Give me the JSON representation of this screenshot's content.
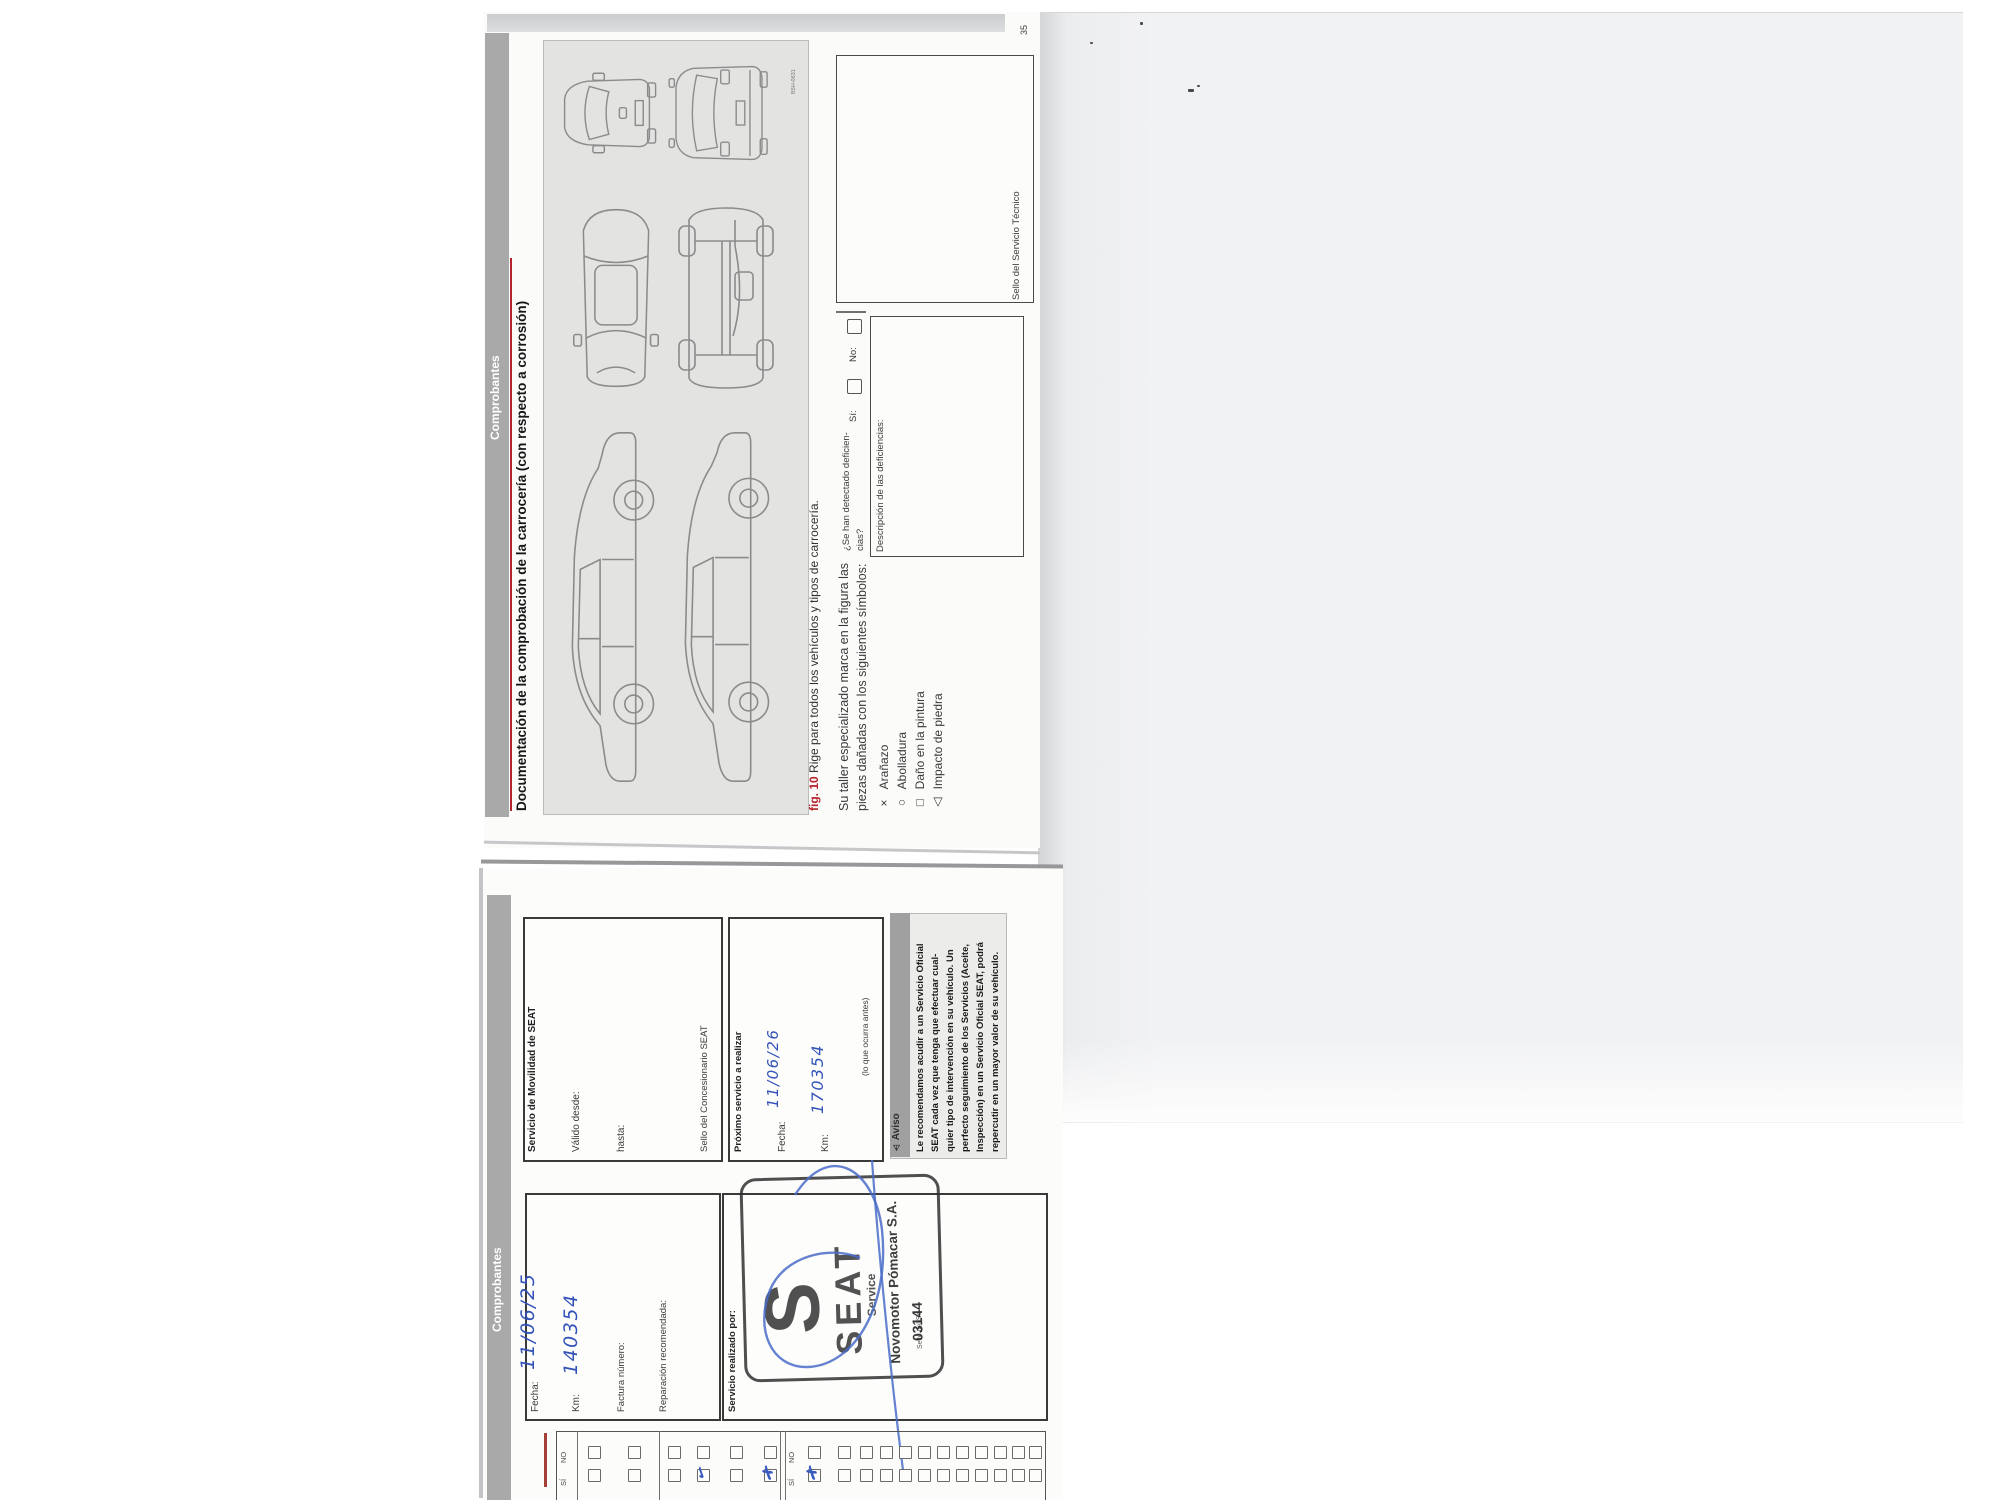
{
  "page35": {
    "page_number": "35",
    "tab_label": "Comprobantes",
    "title": "Documentación de la comprobación de la carrocería (con respecto a corrosión)",
    "figure": {
      "id_code": "B5H-0631",
      "caption_label": "fig. 10",
      "caption_text": "Rige para todos los vehículos y tipos de carrocería."
    },
    "intro_line1": "Su taller especializado marca en la figura las",
    "intro_line2": "piezas dañadas con los siguientes símbolos:",
    "symbols": [
      {
        "glyph": "×",
        "label": "Arañazo"
      },
      {
        "glyph": "○",
        "label": "Abolladura"
      },
      {
        "glyph": "□",
        "label": "Daño en la pintura"
      },
      {
        "glyph": "△",
        "label": "Impacto de piedra"
      }
    ],
    "deficiencies": {
      "question_line1": "¿Se han detectado deficien-",
      "question_line2": "cias?",
      "yes_label": "Sí:",
      "no_label": "No:",
      "description_label": "Descripción de las deficiencias:"
    },
    "technical_stamp_label": "Sello del Servicio Técnico"
  },
  "voucher": {
    "tab_label": "Comprobantes",
    "mobility_box": {
      "title": "Servicio de Movilidad de SEAT",
      "valid_from_label": "Válido desde:",
      "until_label": "hasta:",
      "dealer_stamp_label": "Sello del Concesionario SEAT"
    },
    "next_service_box": {
      "title": "Próximo servicio a realizar",
      "date_label": "Fecha:",
      "date_value": "11/06/26",
      "km_label": "Km:",
      "km_value": "170354",
      "note": "(lo que ocurra antes)"
    },
    "notice_box": {
      "icon": "⚠",
      "header": "Aviso",
      "lines": [
        "Le recomendamos acudir a un Servicio Oficial",
        "SEAT cada vez que tenga que efectuar cual-",
        "quier tipo de intervención en su vehículo. Un",
        "perfecto seguimiento de los Servicios (Aceite,",
        "Inspección) en un Servicio Oficial SEAT, podrá",
        "repercutir en un mayor valor de su vehículo."
      ]
    },
    "record_box": {
      "date_label": "Fecha:",
      "date_value": "11/06/25",
      "km_label": "Km:",
      "km_value": "140354",
      "invoice_label": "Factura número:",
      "repair_label": "Reparación recomendada:"
    },
    "performed_by_box": {
      "label": "Servicio realizado por:",
      "stamp": {
        "logo_letter": "S",
        "brand": "SEAT",
        "subbrand": "Service",
        "dealer": "Novomotor Pómacar S.A.",
        "seal_label": "Sello del Se",
        "seal_number": "03144"
      }
    },
    "checklist": {
      "yes_label": "SÍ",
      "no_label": "NO",
      "marks": [
        "✓",
        "✗",
        "✗"
      ]
    }
  }
}
